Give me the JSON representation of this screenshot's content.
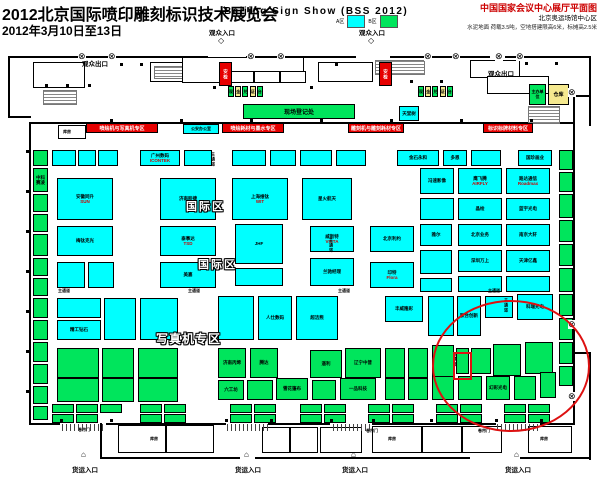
{
  "header": {
    "title_cn": "2012北京国际喷印雕刻标识技术展览会",
    "dates": "2012年3月10日至13日",
    "title_en": "Beijing Sign Show (BSS 2012)",
    "venue_title": "中国国家会议中心展厅平面图",
    "venue_sub": "北京奥运场馆中心区",
    "venue_note": "水泥地面 荷载3.5吨，空地搭建限高6米，标摊高2.5米"
  },
  "legend": {
    "a_label": "A区",
    "a_color": "#00FFFF",
    "b_label": "B区",
    "b_color": "#00E55C"
  },
  "entrances": {
    "visitor_entrance": "观众入口",
    "visitor_exit": "观众出口",
    "freight_entrance": "货运入口"
  },
  "plan": {
    "zone_international": "国际区",
    "zone_photo": "写真机专区",
    "aisle": "主通道",
    "banners": [
      "喷绘机与写真机专区",
      "喷绘耗材与墨水专区",
      "雕刻机与雕刻耗材专区",
      "标识标牌材料专区"
    ],
    "facilities": {
      "security": "安检",
      "registration_desk": [
        "现",
        "金",
        "兑",
        "证",
        "台"
      ],
      "onsite_registration": "现场登记处",
      "warehouse": "仓库",
      "organizer": "主办单位",
      "police_office": "公安办公室",
      "storeroom": "库房",
      "rolling_door": "卷帘门",
      "tiantang": "天堂树"
    },
    "booths": [
      [
        33,
        150,
        15,
        16,
        "cb",
        "",
        ""
      ],
      [
        33,
        168,
        15,
        24,
        "cb",
        "中科赛凌",
        ""
      ],
      [
        33,
        194,
        15,
        18,
        "cb",
        "",
        ""
      ],
      [
        33,
        214,
        15,
        18,
        "cb",
        "",
        ""
      ],
      [
        33,
        234,
        15,
        22,
        "cb",
        "",
        ""
      ],
      [
        33,
        258,
        15,
        18,
        "cb",
        "",
        ""
      ],
      [
        33,
        278,
        15,
        18,
        "cb",
        "",
        ""
      ],
      [
        33,
        298,
        15,
        20,
        "cb",
        "",
        ""
      ],
      [
        33,
        320,
        15,
        20,
        "cb",
        "",
        ""
      ],
      [
        33,
        342,
        15,
        20,
        "cb",
        "",
        ""
      ],
      [
        33,
        364,
        15,
        20,
        "cb",
        "",
        ""
      ],
      [
        33,
        386,
        15,
        18,
        "cb",
        "",
        ""
      ],
      [
        33,
        406,
        15,
        14,
        "cb",
        "",
        ""
      ],
      [
        52,
        150,
        24,
        16,
        "ca",
        "",
        ""
      ],
      [
        78,
        150,
        18,
        16,
        "ca",
        "",
        ""
      ],
      [
        98,
        150,
        20,
        16,
        "ca",
        "",
        ""
      ],
      [
        140,
        150,
        40,
        16,
        "ca",
        "广州数码",
        "ICONTEK"
      ],
      [
        184,
        150,
        28,
        16,
        "ca",
        "",
        ""
      ],
      [
        232,
        150,
        34,
        16,
        "ca",
        "",
        ""
      ],
      [
        270,
        150,
        26,
        16,
        "ca",
        "",
        ""
      ],
      [
        300,
        150,
        32,
        16,
        "ca",
        "",
        ""
      ],
      [
        336,
        150,
        30,
        16,
        "ca",
        "",
        ""
      ],
      [
        397,
        150,
        42,
        16,
        "ca",
        "金石永和",
        ""
      ],
      [
        443,
        150,
        24,
        16,
        "ca",
        "多恩",
        ""
      ],
      [
        471,
        150,
        30,
        16,
        "ca",
        "",
        ""
      ],
      [
        518,
        150,
        34,
        16,
        "ca",
        "国珍画业",
        ""
      ],
      [
        57,
        178,
        56,
        42,
        "ca",
        "安徽同升",
        "SUN"
      ],
      [
        160,
        178,
        56,
        42,
        "ca",
        "济南胶捷",
        ""
      ],
      [
        232,
        178,
        56,
        42,
        "ca",
        "上海维钛",
        "WIT"
      ],
      [
        302,
        178,
        50,
        42,
        "ca",
        "星火航天",
        ""
      ],
      [
        420,
        168,
        34,
        26,
        "ca",
        "冯速影像",
        ""
      ],
      [
        458,
        168,
        44,
        26,
        "ca",
        "鹰飞腾",
        "AIRFLY"
      ],
      [
        506,
        168,
        44,
        26,
        "ca",
        "路达通信",
        "Roadmax"
      ],
      [
        420,
        198,
        34,
        22,
        "ca",
        "",
        ""
      ],
      [
        458,
        198,
        44,
        22,
        "ca",
        "晶绘",
        ""
      ],
      [
        506,
        198,
        44,
        22,
        "ca",
        "蓝宇光电",
        ""
      ],
      [
        57,
        226,
        56,
        30,
        "ca",
        "梅钛克光",
        ""
      ],
      [
        160,
        226,
        56,
        30,
        "ca",
        "泰事达",
        "TSD"
      ],
      [
        235,
        224,
        48,
        40,
        "ca",
        "JHF",
        ""
      ],
      [
        310,
        226,
        44,
        26,
        "ca",
        "威斯特",
        "VISTA"
      ],
      [
        370,
        226,
        44,
        26,
        "ca",
        "北京利约",
        ""
      ],
      [
        420,
        224,
        32,
        22,
        "ca",
        "雅尔",
        ""
      ],
      [
        458,
        224,
        44,
        22,
        "ca",
        "北京业务",
        ""
      ],
      [
        506,
        224,
        44,
        22,
        "ca",
        "南京大轩",
        ""
      ],
      [
        57,
        262,
        28,
        26,
        "ca",
        "",
        ""
      ],
      [
        88,
        262,
        26,
        26,
        "ca",
        "",
        ""
      ],
      [
        160,
        262,
        56,
        26,
        "ca",
        "美嘉",
        ""
      ],
      [
        235,
        268,
        48,
        18,
        "ca",
        "",
        ""
      ],
      [
        310,
        258,
        44,
        28,
        "ca",
        "兰驰经理",
        ""
      ],
      [
        370,
        262,
        44,
        26,
        "ca",
        "印特",
        "Flora"
      ],
      [
        420,
        250,
        32,
        24,
        "ca",
        "",
        ""
      ],
      [
        458,
        250,
        44,
        22,
        "ca",
        "深圳万上",
        ""
      ],
      [
        506,
        250,
        44,
        22,
        "ca",
        "天津亿鑫",
        ""
      ],
      [
        420,
        278,
        32,
        14,
        "ca",
        "",
        ""
      ],
      [
        458,
        276,
        44,
        16,
        "ca",
        "",
        ""
      ],
      [
        506,
        276,
        44,
        16,
        "ca",
        "",
        ""
      ],
      [
        57,
        298,
        44,
        20,
        "ca",
        "",
        ""
      ],
      [
        57,
        320,
        44,
        20,
        "ca",
        "精工钻石",
        ""
      ],
      [
        104,
        298,
        32,
        42,
        "ca",
        "",
        ""
      ],
      [
        140,
        298,
        38,
        42,
        "ca",
        "",
        ""
      ],
      [
        218,
        296,
        36,
        44,
        "ca",
        "",
        ""
      ],
      [
        258,
        296,
        34,
        44,
        "ca",
        "人仕数码",
        ""
      ],
      [
        296,
        296,
        42,
        44,
        "ca",
        "超洁熊",
        ""
      ],
      [
        385,
        296,
        38,
        26,
        "ca",
        "丰威隆彩",
        ""
      ],
      [
        428,
        296,
        26,
        40,
        "ca",
        "",
        ""
      ],
      [
        457,
        296,
        24,
        40,
        "ca",
        "联合创新",
        ""
      ],
      [
        485,
        296,
        28,
        22,
        "ca",
        "",
        ""
      ],
      [
        517,
        294,
        36,
        26,
        "ca",
        "科瑞光电",
        ""
      ],
      [
        57,
        348,
        42,
        30,
        "cb",
        "",
        ""
      ],
      [
        102,
        348,
        32,
        30,
        "cb",
        "",
        ""
      ],
      [
        138,
        348,
        40,
        30,
        "cb",
        "",
        ""
      ],
      [
        218,
        348,
        28,
        30,
        "cb",
        "济南丙烯",
        ""
      ],
      [
        250,
        348,
        28,
        30,
        "cb",
        "腾达",
        ""
      ],
      [
        310,
        350,
        32,
        28,
        "cb",
        "遥利",
        ""
      ],
      [
        345,
        348,
        36,
        30,
        "cb",
        "辽宁中普",
        ""
      ],
      [
        385,
        348,
        20,
        30,
        "cb",
        "",
        ""
      ],
      [
        408,
        348,
        20,
        30,
        "cb",
        "",
        ""
      ],
      [
        432,
        345,
        22,
        32,
        "cb",
        "",
        ""
      ],
      [
        456,
        348,
        13,
        26,
        "cb",
        "",
        ""
      ],
      [
        471,
        348,
        20,
        26,
        "cb",
        "",
        ""
      ],
      [
        493,
        344,
        28,
        32,
        "cb",
        "",
        ""
      ],
      [
        525,
        342,
        28,
        32,
        "cb",
        "",
        ""
      ],
      [
        57,
        378,
        42,
        24,
        "cb",
        "",
        ""
      ],
      [
        102,
        378,
        32,
        24,
        "cb",
        "",
        ""
      ],
      [
        138,
        378,
        40,
        24,
        "cb",
        "",
        ""
      ],
      [
        218,
        380,
        26,
        20,
        "cb",
        "六工坊",
        ""
      ],
      [
        247,
        380,
        26,
        20,
        "cb",
        "",
        ""
      ],
      [
        276,
        378,
        32,
        22,
        "cb",
        "雪花篷布",
        ""
      ],
      [
        312,
        380,
        24,
        20,
        "cb",
        "",
        ""
      ],
      [
        340,
        378,
        36,
        22,
        "cb",
        "一品科技",
        ""
      ],
      [
        385,
        378,
        20,
        22,
        "cb",
        "",
        ""
      ],
      [
        408,
        378,
        20,
        22,
        "cb",
        "",
        ""
      ],
      [
        432,
        376,
        22,
        24,
        "cb",
        "",
        ""
      ],
      [
        458,
        376,
        24,
        24,
        "cb",
        "",
        ""
      ],
      [
        486,
        376,
        24,
        24,
        "cb",
        "幻彩光电",
        ""
      ],
      [
        514,
        376,
        22,
        24,
        "cb",
        "",
        ""
      ],
      [
        540,
        372,
        16,
        26,
        "cb",
        "",
        ""
      ],
      [
        52,
        404,
        22,
        9,
        "cb",
        "",
        ""
      ],
      [
        76,
        404,
        22,
        9,
        "cb",
        "",
        ""
      ],
      [
        100,
        404,
        22,
        9,
        "cb",
        "",
        ""
      ],
      [
        140,
        404,
        22,
        9,
        "cb",
        "",
        ""
      ],
      [
        164,
        404,
        22,
        9,
        "cb",
        "",
        ""
      ],
      [
        230,
        404,
        22,
        9,
        "cb",
        "",
        ""
      ],
      [
        254,
        404,
        22,
        9,
        "cb",
        "",
        ""
      ],
      [
        300,
        404,
        22,
        9,
        "cb",
        "",
        ""
      ],
      [
        324,
        404,
        22,
        9,
        "cb",
        "",
        ""
      ],
      [
        368,
        404,
        22,
        9,
        "cb",
        "",
        ""
      ],
      [
        392,
        404,
        22,
        9,
        "cb",
        "",
        ""
      ],
      [
        436,
        404,
        22,
        9,
        "cb",
        "",
        ""
      ],
      [
        460,
        404,
        22,
        9,
        "cb",
        "",
        ""
      ],
      [
        504,
        404,
        22,
        9,
        "cb",
        "",
        ""
      ],
      [
        528,
        404,
        22,
        9,
        "cb",
        "",
        ""
      ],
      [
        52,
        414,
        22,
        9,
        "cb",
        "",
        ""
      ],
      [
        76,
        414,
        22,
        9,
        "cb",
        "",
        ""
      ],
      [
        140,
        414,
        22,
        9,
        "cb",
        "",
        ""
      ],
      [
        164,
        414,
        22,
        9,
        "cb",
        "",
        ""
      ],
      [
        230,
        414,
        22,
        9,
        "cb",
        "",
        ""
      ],
      [
        254,
        414,
        22,
        9,
        "cb",
        "",
        ""
      ],
      [
        300,
        414,
        22,
        9,
        "cb",
        "",
        ""
      ],
      [
        324,
        414,
        22,
        9,
        "cb",
        "",
        ""
      ],
      [
        368,
        414,
        22,
        9,
        "cb",
        "",
        ""
      ],
      [
        392,
        414,
        22,
        9,
        "cb",
        "",
        ""
      ],
      [
        436,
        414,
        22,
        9,
        "cb",
        "",
        ""
      ],
      [
        460,
        414,
        22,
        9,
        "cb",
        "",
        ""
      ],
      [
        504,
        414,
        22,
        9,
        "cb",
        "",
        ""
      ],
      [
        528,
        414,
        22,
        9,
        "cb",
        "",
        ""
      ],
      [
        559,
        150,
        14,
        20,
        "cb",
        "",
        ""
      ],
      [
        559,
        172,
        14,
        20,
        "cb",
        "",
        ""
      ],
      [
        559,
        194,
        14,
        24,
        "cb",
        "",
        ""
      ],
      [
        559,
        220,
        14,
        22,
        "cb",
        "",
        ""
      ],
      [
        559,
        244,
        14,
        22,
        "cb",
        "",
        ""
      ],
      [
        559,
        268,
        14,
        24,
        "cb",
        "",
        ""
      ],
      [
        559,
        294,
        14,
        22,
        "cb",
        "",
        ""
      ],
      [
        559,
        318,
        14,
        22,
        "cb",
        "",
        ""
      ],
      [
        559,
        342,
        14,
        22,
        "cb",
        "",
        ""
      ],
      [
        559,
        366,
        14,
        20,
        "cb",
        "",
        ""
      ]
    ]
  },
  "annotation": {
    "color": "#DD1111"
  }
}
